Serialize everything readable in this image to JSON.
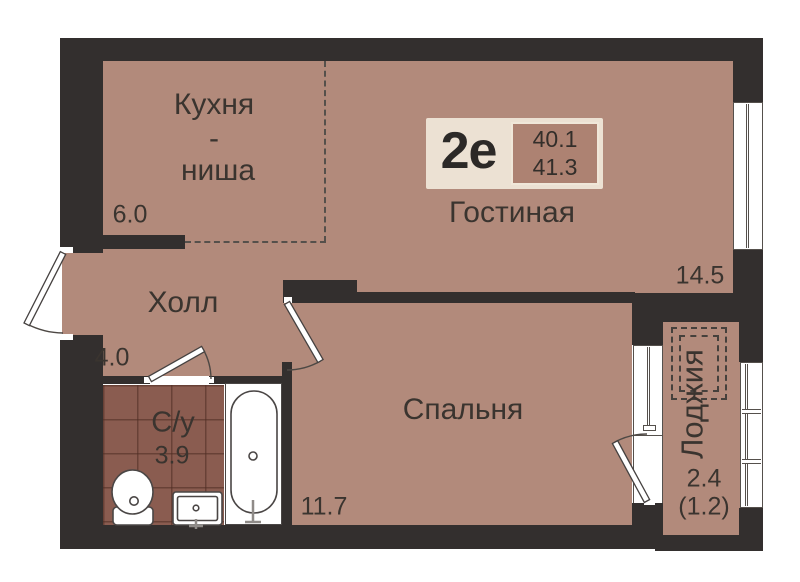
{
  "unit_badge": {
    "unit_type": "2е",
    "area_top": "40.1",
    "area_bottom": "41.3"
  },
  "rooms": {
    "kitchen": {
      "name_line1": "Кухня",
      "name_line2": "-",
      "name_line3": "ниша",
      "area": "6.0"
    },
    "living": {
      "name": "Гостиная",
      "area": "14.5"
    },
    "hall": {
      "name": "Холл",
      "area": "4.0"
    },
    "bathroom": {
      "name": "С/у",
      "area": "3.9"
    },
    "bedroom": {
      "name": "Спальня",
      "area": "11.7"
    },
    "loggia": {
      "name": "Лоджия",
      "area": "2.4",
      "area_secondary": "(1.2)"
    }
  },
  "fixtures": [
    "toilet",
    "sink",
    "bathtub"
  ],
  "colors": {
    "wall": "#332f2e",
    "floor": "#b28a7b",
    "bathroom_tile": "#8a5c50",
    "badge_background": "#ece1d3",
    "badge_inner": "#ad8272",
    "text": "#3a342f",
    "fixture_white": "#ffffff"
  }
}
